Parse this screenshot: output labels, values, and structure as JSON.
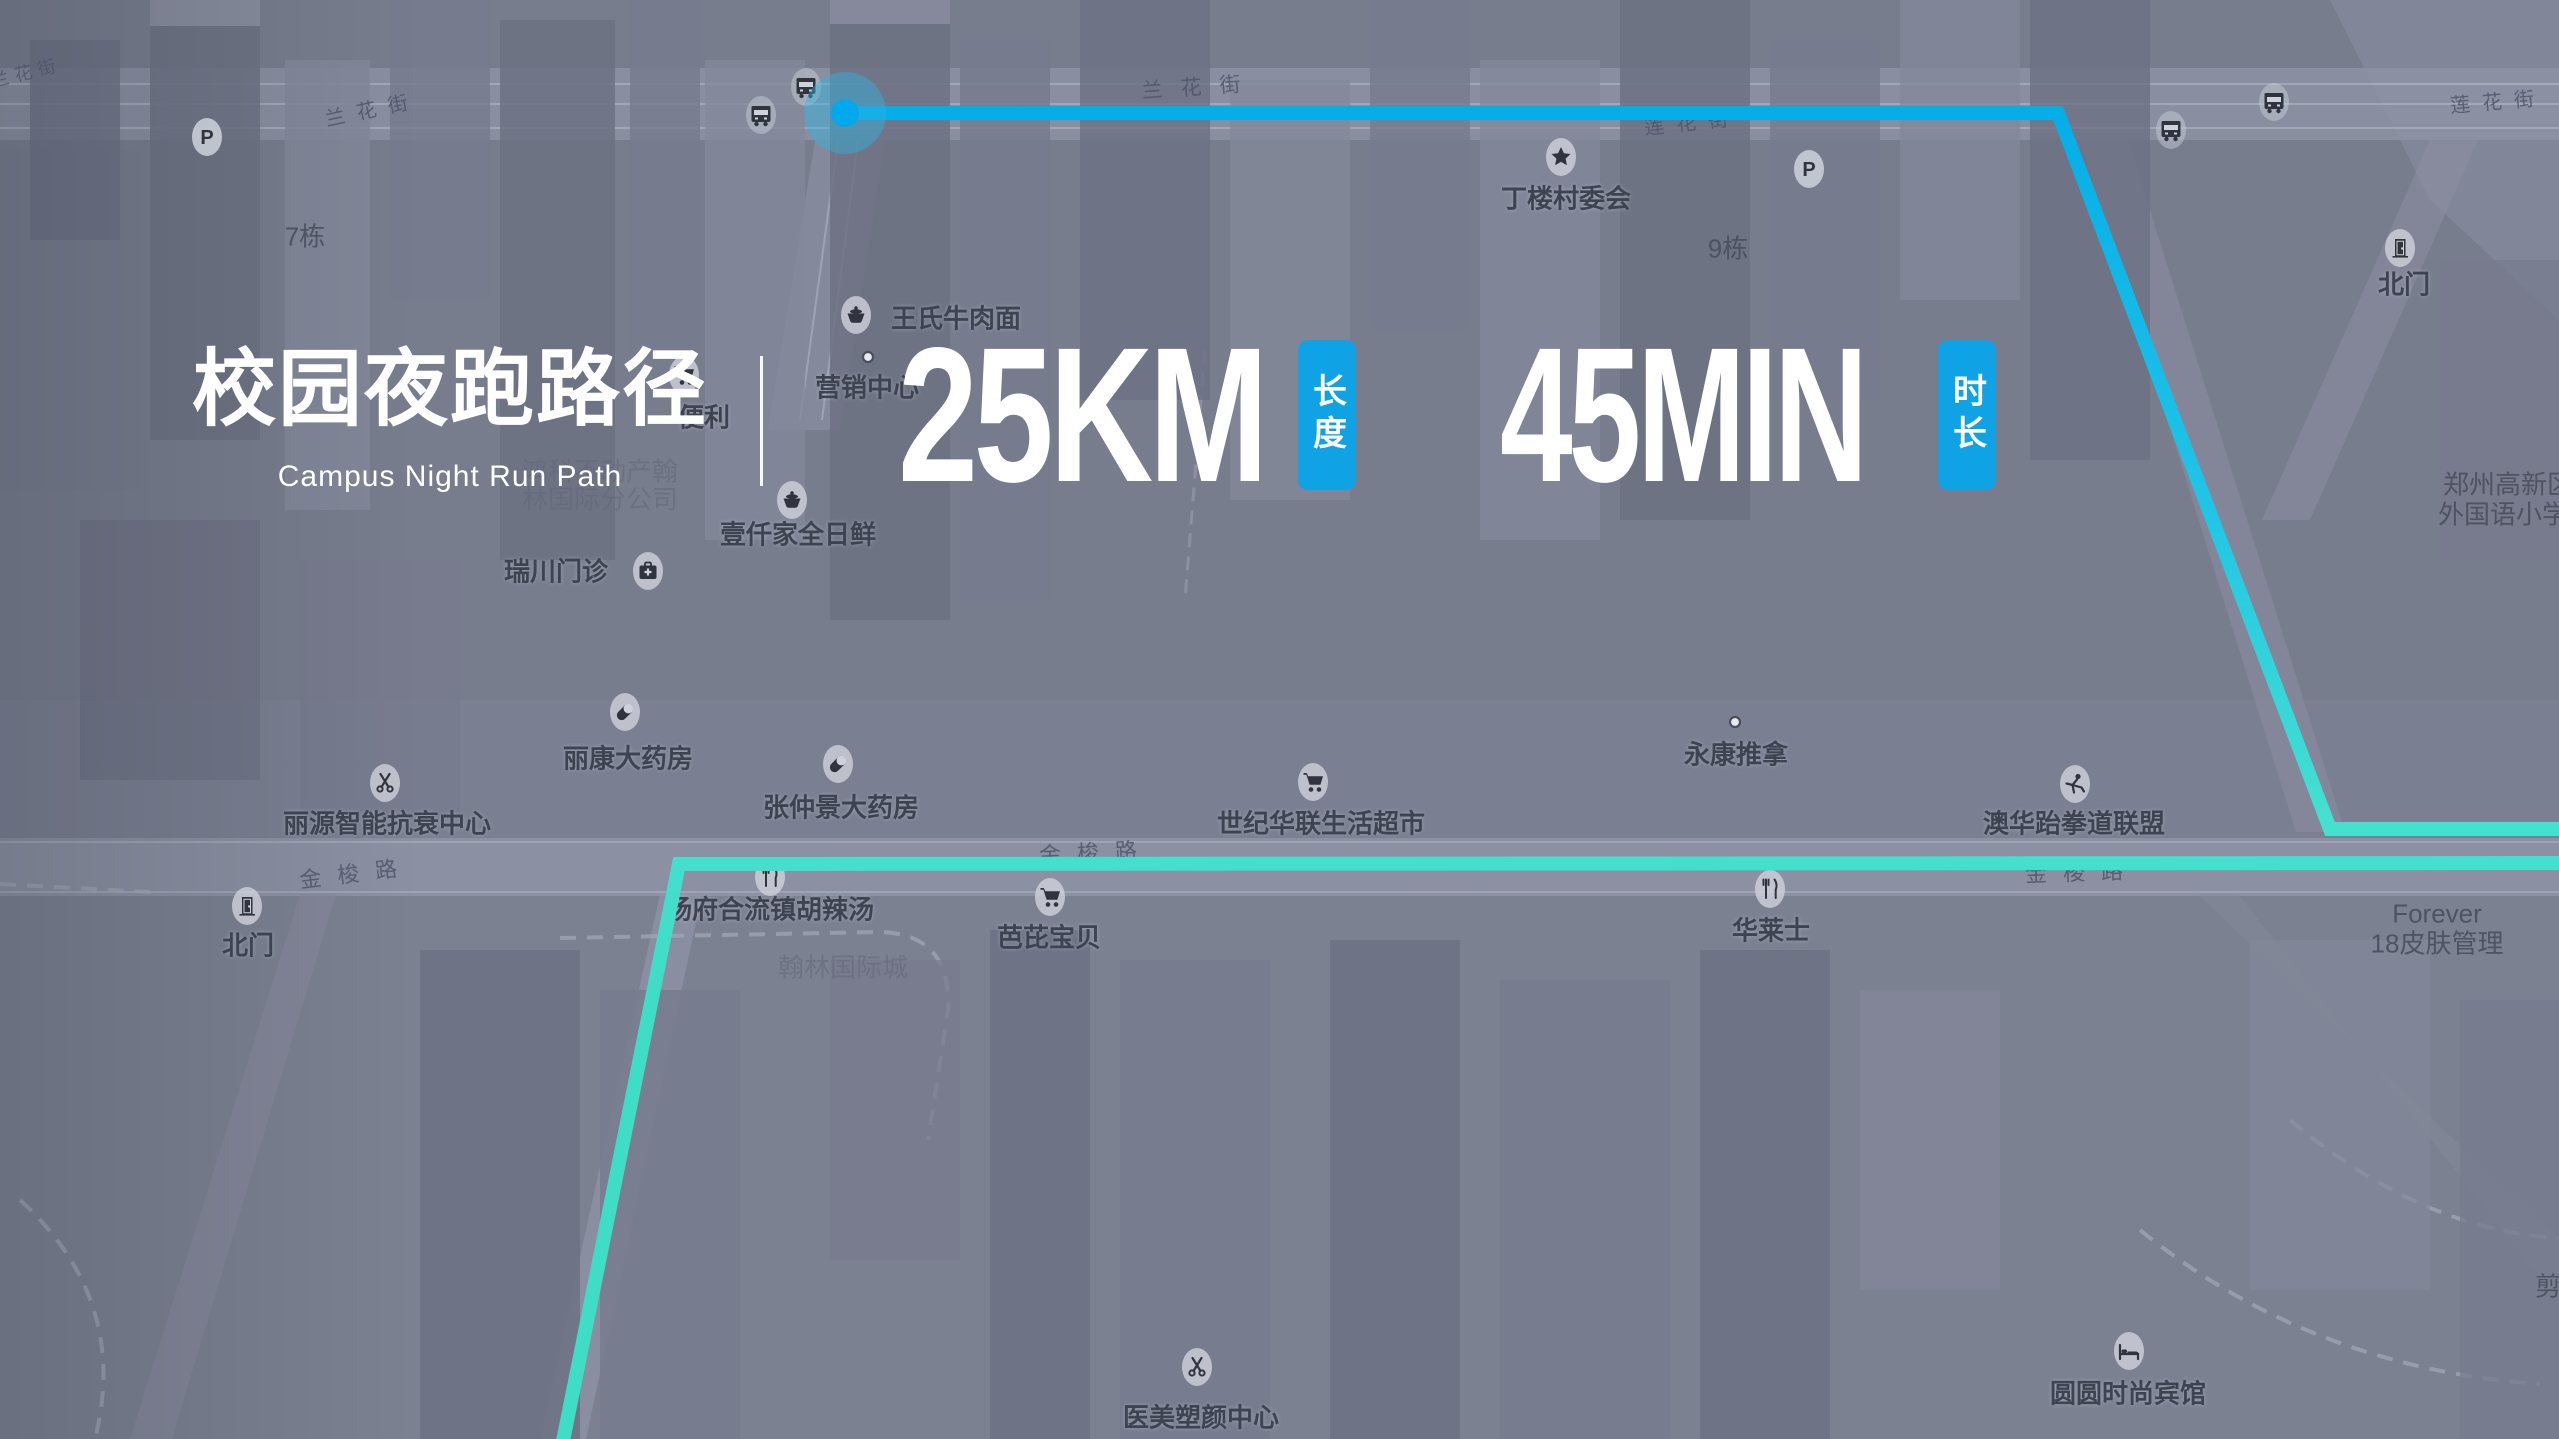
{
  "overlay": {
    "title": "校园夜跑路径",
    "subtitle": "Campus Night Run Path",
    "accent_color": "#0fa3e6",
    "stats": [
      {
        "value": "25KM",
        "badge": "长度"
      },
      {
        "value": "45MIN",
        "badge": "时长"
      }
    ]
  },
  "route": {
    "color_start": "#05ade8",
    "color_mid": "#20c5e6",
    "color_end": "#3fdcc6",
    "stroke_width": 14,
    "polylines": [
      {
        "points": [
          [
            845,
            113
          ],
          [
            2058,
            113
          ],
          [
            2330,
            829
          ],
          [
            2562,
            829
          ]
        ]
      },
      {
        "points": [
          [
            2562,
            863
          ],
          [
            679,
            864
          ],
          [
            563,
            1441
          ]
        ]
      }
    ],
    "start_marker": {
      "x": 845,
      "y": 113,
      "dot_color": "#00a9ec",
      "glow_color": "#2fb4e0"
    }
  },
  "map": {
    "road_labels": [
      {
        "text": "兰花街",
        "x": 26,
        "y": 72,
        "angle": -14,
        "size": 18,
        "ls": 6
      },
      {
        "text": "兰花街",
        "x": 372,
        "y": 108,
        "angle": -12,
        "size": 20,
        "ls": 12
      },
      {
        "text": "兰花街",
        "x": 1200,
        "y": 86,
        "angle": -4,
        "size": 21,
        "ls": 18
      },
      {
        "text": "莲花街",
        "x": 1692,
        "y": 121,
        "angle": -6,
        "size": 20,
        "ls": 12
      },
      {
        "text": "莲花街",
        "x": 2498,
        "y": 100,
        "angle": -5,
        "size": 20,
        "ls": 12
      },
      {
        "text": "金梭路",
        "x": 356,
        "y": 872,
        "angle": -7,
        "size": 22,
        "ls": 16
      },
      {
        "text": "金梭路",
        "x": 1096,
        "y": 851,
        "angle": -3,
        "size": 22,
        "ls": 16
      },
      {
        "text": "金梭路",
        "x": 2082,
        "y": 871,
        "angle": -2,
        "size": 22,
        "ls": 16
      }
    ],
    "building_labels": [
      {
        "text": "7栋",
        "x": 305,
        "y": 235
      },
      {
        "text": "9栋",
        "x": 1728,
        "y": 247
      },
      {
        "text": "鸿科不动产翰",
        "x": 600,
        "y": 470,
        "faint": true
      },
      {
        "text": "林国际分公司",
        "x": 600,
        "y": 498,
        "faint": true
      },
      {
        "text": "翰林国际城",
        "x": 843,
        "y": 966,
        "faint": true
      },
      {
        "text": "Forever",
        "x": 2437,
        "y": 914
      },
      {
        "text": "18皮肤管理",
        "x": 2437,
        "y": 942
      },
      {
        "text": "郑州高新区",
        "x": 2508,
        "y": 483
      },
      {
        "text": "外国语小学",
        "x": 2503,
        "y": 513
      },
      {
        "text": "剪",
        "x": 2548,
        "y": 1285
      }
    ],
    "pois": [
      {
        "icon": "parking-icon",
        "label": "",
        "x": 207,
        "y": 137
      },
      {
        "icon": "parking-icon",
        "label": "",
        "x": 1809,
        "y": 169
      },
      {
        "icon": "bus-icon",
        "label": "",
        "x": 761,
        "y": 115
      },
      {
        "icon": "bus-icon",
        "label": "",
        "x": 806,
        "y": 87
      },
      {
        "icon": "bus-icon",
        "label": "",
        "x": 2171,
        "y": 130
      },
      {
        "icon": "bus-icon",
        "label": "",
        "x": 2274,
        "y": 102
      },
      {
        "icon": "star-icon",
        "label": "丁楼村委会",
        "x": 1561,
        "y": 157,
        "lx": 1566,
        "ly": 197
      },
      {
        "icon": "door-icon",
        "label": "北门",
        "x": 2400,
        "y": 248,
        "lx": 2404,
        "ly": 283
      },
      {
        "icon": "food-icon",
        "label": "王氏牛肉面",
        "x": 856,
        "y": 315,
        "lx": 956,
        "ly": 317
      },
      {
        "icon": "dot-icon",
        "label": "营销中心",
        "x": 868,
        "y": 357,
        "lx": 867,
        "ly": 386
      },
      {
        "icon": "cart-icon",
        "label": "便利",
        "x": 684,
        "y": 375,
        "lx": 704,
        "ly": 416
      },
      {
        "icon": "firstaid-icon",
        "label": "瑞川门诊",
        "x": 648,
        "y": 571,
        "lx": 556,
        "ly": 570
      },
      {
        "icon": "food-icon",
        "label": "壹仟家全日鲜",
        "x": 792,
        "y": 500,
        "lx": 798,
        "ly": 533
      },
      {
        "icon": "pill-icon",
        "label": "丽康大药房",
        "x": 625,
        "y": 712,
        "lx": 628,
        "ly": 757
      },
      {
        "icon": "scissors-icon",
        "label": "丽源智能抗衰中心",
        "x": 385,
        "y": 783,
        "lx": 387,
        "ly": 822
      },
      {
        "icon": "door-icon",
        "label": "北门",
        "x": 247,
        "y": 906,
        "lx": 248,
        "ly": 944
      },
      {
        "icon": "pill-icon",
        "label": "张仲景大药房",
        "x": 838,
        "y": 764,
        "lx": 841,
        "ly": 806
      },
      {
        "icon": "fork-icon",
        "label": "杨府合流镇胡辣汤",
        "x": 770,
        "y": 877,
        "lx": 770,
        "ly": 908
      },
      {
        "icon": "cart-icon",
        "label": "芭芘宝贝",
        "x": 1050,
        "y": 897,
        "lx": 1049,
        "ly": 936
      },
      {
        "icon": "cart-icon",
        "label": "世纪华联生活超市",
        "x": 1313,
        "y": 782,
        "lx": 1321,
        "ly": 822
      },
      {
        "icon": "dot-icon",
        "label": "永康推拿",
        "x": 1735,
        "y": 722,
        "lx": 1736,
        "ly": 753
      },
      {
        "icon": "taekwondo-icon",
        "label": "澳华跆拳道联盟",
        "x": 2075,
        "y": 784,
        "lx": 2074,
        "ly": 822
      },
      {
        "icon": "fork-icon",
        "label": "华莱士",
        "x": 1770,
        "y": 889,
        "lx": 1771,
        "ly": 929
      },
      {
        "icon": "scissors-icon",
        "label": "医美塑颜中心",
        "x": 1197,
        "y": 1367,
        "lx": 1201,
        "ly": 1416
      },
      {
        "icon": "bed-icon",
        "label": "圆圆时尚宾馆",
        "x": 2129,
        "y": 1351,
        "lx": 2128,
        "ly": 1392
      }
    ]
  }
}
